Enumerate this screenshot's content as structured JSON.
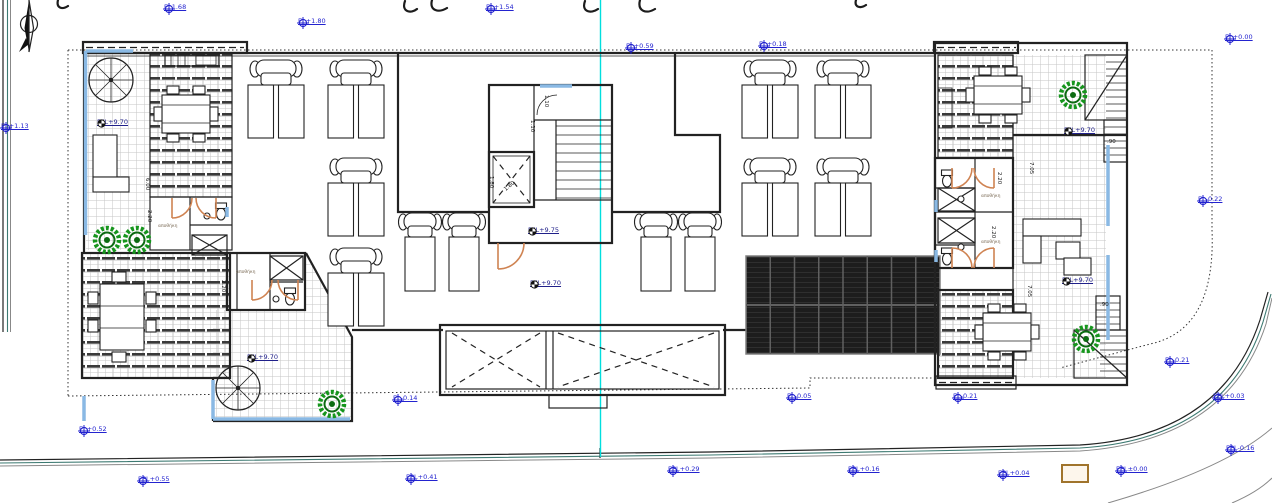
{
  "title": "roof-level architectural floor plan",
  "colors": {
    "marker_blue": "#2323cf",
    "ffl_blue": "#20208a",
    "door_orange": "#cf8352",
    "rail_blue": "#8ab9e4",
    "section_cyan": "#00dede",
    "road_teal": "#3d7a72",
    "plant_green": "#16951d",
    "plant_dark": "#0c6b12",
    "solar_dark": "#1d1d1d",
    "wall": "#222222"
  },
  "annotations": {
    "elevation_markers": [
      {
        "label": "EL1.68",
        "x": 163,
        "y": 3
      },
      {
        "label": "EL+1.80",
        "x": 297,
        "y": 17
      },
      {
        "label": "EL+1.54",
        "x": 485,
        "y": 3
      },
      {
        "label": "EL+0.59",
        "x": 625,
        "y": 42
      },
      {
        "label": "EL+0.18",
        "x": 758,
        "y": 40
      },
      {
        "label": "EL+0.00",
        "x": 1224,
        "y": 33
      },
      {
        "label": "EL+1.13",
        "x": 0,
        "y": 122
      },
      {
        "label": "EL-0.22",
        "x": 1197,
        "y": 195
      },
      {
        "label": "EL-0.21",
        "x": 1164,
        "y": 356
      },
      {
        "label": "EPL+0.03",
        "x": 1212,
        "y": 392
      },
      {
        "label": "EPL-0.16",
        "x": 1225,
        "y": 444
      },
      {
        "label": "EL-0.21",
        "x": 952,
        "y": 392
      },
      {
        "label": "EL-0.05",
        "x": 786,
        "y": 392
      },
      {
        "label": "EL-0.14",
        "x": 392,
        "y": 394
      },
      {
        "label": "EL+0.52",
        "x": 78,
        "y": 425
      },
      {
        "label": "EPL+0.55",
        "x": 137,
        "y": 475
      },
      {
        "label": "EPL+0.41",
        "x": 405,
        "y": 473
      },
      {
        "label": "EPL+0.29",
        "x": 667,
        "y": 465
      },
      {
        "label": "EPL+0.16",
        "x": 847,
        "y": 465
      },
      {
        "label": "EPL+0.04",
        "x": 997,
        "y": 469
      },
      {
        "label": "EPL±0.00",
        "x": 1115,
        "y": 465
      }
    ],
    "ffl_markers": [
      {
        "label": "FFL+9.70",
        "x": 96,
        "y": 118
      },
      {
        "label": "FFL+9.75",
        "x": 527,
        "y": 226
      },
      {
        "label": "FFL+9.70",
        "x": 529,
        "y": 279
      },
      {
        "label": "FFL+9.70",
        "x": 246,
        "y": 353
      },
      {
        "label": "FFL+9.70",
        "x": 1063,
        "y": 126
      },
      {
        "label": "FFL+9.70",
        "x": 1061,
        "y": 276
      }
    ],
    "dimensions": [
      {
        "label": "6.00",
        "x": 150,
        "y": 178,
        "rot": 90
      },
      {
        "label": "2.20",
        "x": 152,
        "y": 210,
        "rot": 90
      },
      {
        "label": "2.20",
        "x": 226,
        "y": 280,
        "rot": 90
      },
      {
        "label": "1.10",
        "x": 549,
        "y": 95,
        "rot": 90
      },
      {
        "label": "1.10",
        "x": 535,
        "y": 120,
        "rot": 90
      },
      {
        "label": "1.80",
        "x": 494,
        "y": 176,
        "rot": 90
      },
      {
        "label": "1.80",
        "x": 503,
        "y": 188,
        "rot": -40
      },
      {
        "label": "7.05",
        "x": 1034,
        "y": 162,
        "rot": 90
      },
      {
        "label": "7.05",
        "x": 1032,
        "y": 285,
        "rot": 90
      },
      {
        "label": "2.20",
        "x": 1002,
        "y": 172,
        "rot": 90
      },
      {
        "label": "2.20",
        "x": 996,
        "y": 226,
        "rot": 90
      },
      {
        "label": ".90",
        "x": 1107,
        "y": 139,
        "rot": 0
      },
      {
        "label": ".90",
        "x": 1100,
        "y": 302,
        "rot": 0
      }
    ],
    "room_labels": [
      {
        "label": "αποθήκη",
        "x": 158,
        "y": 224,
        "rot": 0
      },
      {
        "label": "αποθήκη",
        "x": 236,
        "y": 270,
        "rot": 0
      },
      {
        "label": "αποθήκη",
        "x": 981,
        "y": 194,
        "rot": 0
      },
      {
        "label": "αποθήκη",
        "x": 981,
        "y": 240,
        "rot": 0
      }
    ]
  }
}
